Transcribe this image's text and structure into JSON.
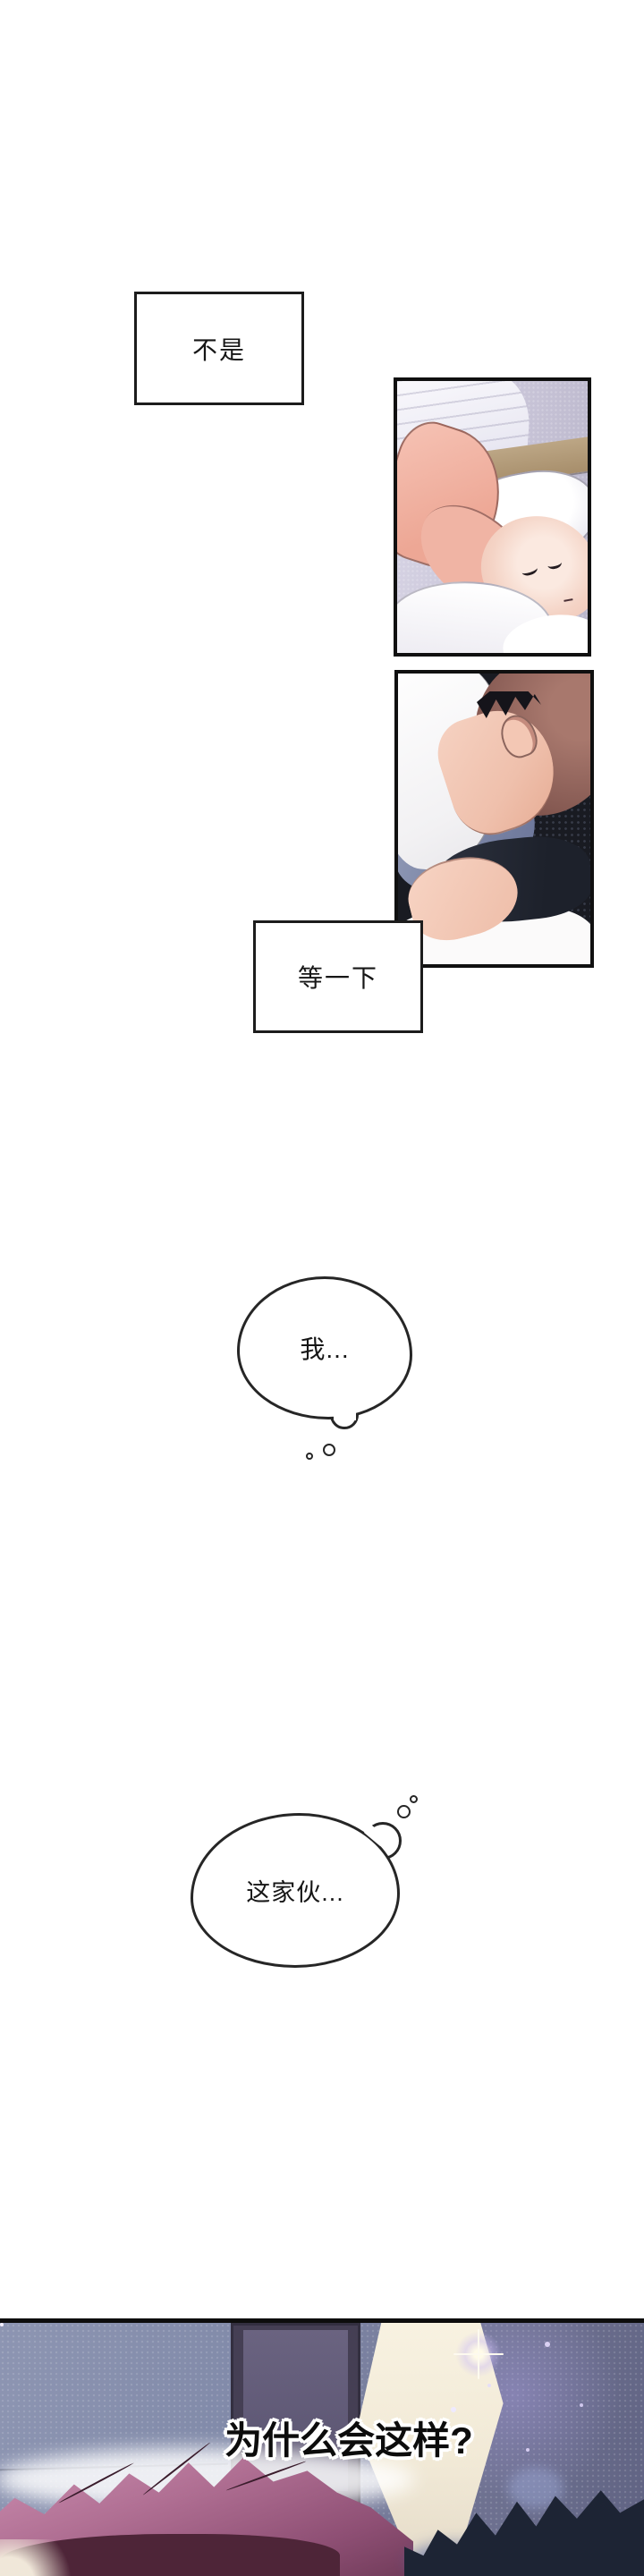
{
  "page": {
    "type": "webtoon-comic-page",
    "background": "#ffffff"
  },
  "dialogue": {
    "box1": "不是",
    "box2": "等一下",
    "thought1": "我...",
    "thought2": "这家伙...",
    "bottom_caption": "为什么会这样?"
  },
  "scenes": {
    "panel1": "person-sleeping-in-bed",
    "panel2": "two-faces-close-together",
    "panel3": "dark-room-pink-hair-figure-with-sparkles"
  },
  "palette": {
    "panel_border": "#101010",
    "wall_lavender": "#cbc7da",
    "headboard_tan": "#b29a79",
    "skin": "#f0c4b0",
    "hair_auburn": "#8f625a",
    "hair_dark": "#1d2434",
    "fabric_blue": "#7e88a8",
    "night_wall": "#7b7fa0",
    "hair_pink": "#b06f93",
    "glow_cream": "#f5efdd"
  }
}
